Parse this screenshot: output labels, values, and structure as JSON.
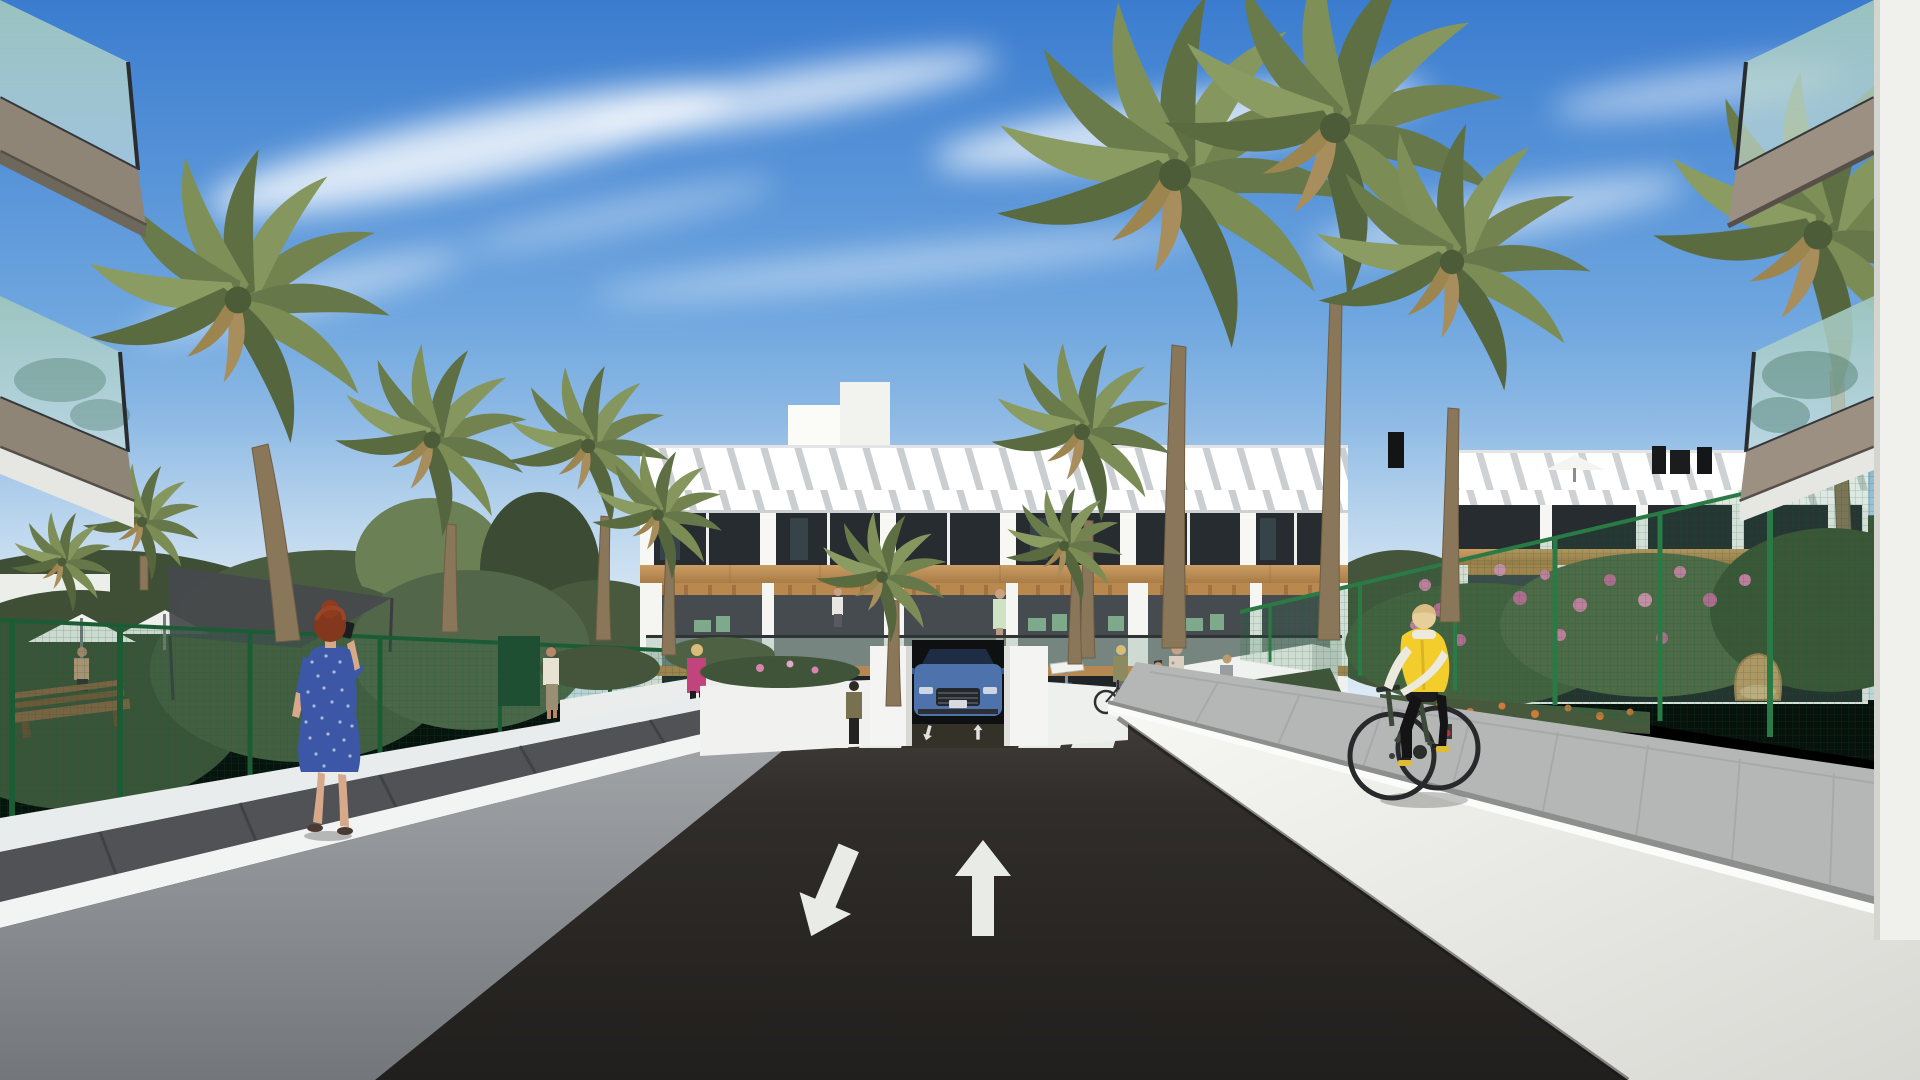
{
  "scene": {
    "type": "3d-architectural-render",
    "description": "Street-level view of a modern white Mediterranean apartment complex lined with palm trees; a two-lane asphalt drive leads to an underground garage beneath the central building",
    "lighting": "bright sunny day",
    "sky": {
      "top_color": "#3b7ccf",
      "horizon_color": "#dcebf6",
      "clouds": "wispy diagonal white streaks"
    }
  },
  "palette": {
    "building_white": "#f7f7f4",
    "timber_accent": "#c0915a",
    "glass_teal": "#a5cdc4",
    "balcony_fascia_bronze": "#8f8577",
    "fence_green": "#1c5c35",
    "road_asphalt": "#262321",
    "road_marking_white": "#e9ebe7",
    "wall_white": "#f2f4f4",
    "wall_shadow_grey": "#84878a",
    "pavement_light": "#b4b7b6",
    "pavement_dark": "#515256",
    "foliage_dark": "#3e4f36",
    "palm_frond_green": "#7a8a57",
    "palm_trunk_brown": "#8a775a",
    "flower_pink": "#d984ad",
    "flower_orange": "#cf7a3a",
    "car_blue": "#4e73ac",
    "vest_yellow": "#f2cd2c",
    "dress_blue": "#3c57a6",
    "hair_red": "#83371c"
  },
  "road": {
    "lanes": 2,
    "markings": {
      "left_lane": "white arrow pointing toward viewer (oncoming)",
      "right_lane": "white arrow pointing away (ahead)",
      "crosswalk_stripes": 6,
      "ramp_arrows": "small down and up arrows at garage ramp"
    }
  },
  "garage": {
    "description": "underground parking ramp entrance centered under the building, flanked by white walls"
  },
  "vehicles": {
    "suv": {
      "description": "blue SUV driving up out of the underground garage ramp",
      "body_color": "#4e73ac"
    }
  },
  "buildings": {
    "central": {
      "floors": 3,
      "style": "white render with timber cladding band, wood pergolas, glass balustrades, green balcony furniture",
      "roof": "terrace with white parasol, dark solar panel and black chimney flues"
    },
    "right_wing": {
      "floors": 3,
      "style": "matching white block behind green mesh fence and flowering garden",
      "roof": "white parasol and black flues"
    },
    "foreground_left": {
      "element": "two stacked glass balconies with bronze fascia at left image edge"
    },
    "foreground_right": {
      "element": "two stacked glass balconies with bronze fascia and white corner column at right image edge"
    }
  },
  "landscape": {
    "palms": 13,
    "fences": "dark green mesh garden fencing both sides",
    "flowers": [
      "pink shrubs on the right garden",
      "orange marigold beds by the walkways"
    ],
    "pool_garden_left": "white parasols, timber bench, grey shade sail behind the fence"
  },
  "street_furniture": {
    "bike_racks": 5,
    "bench": "timber bench in left pool garden",
    "rattan_chair": "round rattan chair in right garden",
    "info_sign": "small white plate beside garage portal"
  },
  "people": {
    "woman_blue_dress": {
      "description": "red-haired woman in a knee-length blue patterned dress seen from behind, phone to her ear, walking on the left walkway",
      "dress_color": "#3c57a6",
      "hair_color": "#83371c"
    },
    "cyclist": {
      "description": "blonde woman in a yellow gilet, white sleeves and black leggings riding a dark green city bike toward the buildings on the right walkway",
      "vest_color": "#f2cd2c"
    },
    "man_cream_shirt": {
      "description": "man in a cream t-shirt and khaki trousers walking away on the left garden path"
    },
    "woman_magenta_jacket": {
      "description": "blonde woman in a magenta jacket with black trousers and a brown handbag walking on the left garden path",
      "jacket_color": "#c2447c"
    },
    "woman_with_bicycle": {
      "description": "woman standing with her bicycle at the bike racks right of the garage"
    },
    "woman_and_child": {
      "description": "dark-haired woman in a floral top and jeans with a small child in an olive jacket near the bike racks"
    },
    "woman_grey_top": {
      "description": "woman in grey walking behind the bike racks"
    },
    "man_olive_jacket": {
      "description": "person in an olive jacket standing beside the garage ramp"
    },
    "balcony_resident": {
      "description": "resident in a light green dress standing on a first-floor balcony of the central building"
    },
    "balcony_resident_left": {
      "description": "resident in a white top on a left first-floor balcony"
    },
    "balcony_couple": {
      "description": "couple standing together on a first-floor balcony of the right wing"
    },
    "pool_man": {
      "description": "shirtless man in the fenced pool garden on the left"
    }
  }
}
